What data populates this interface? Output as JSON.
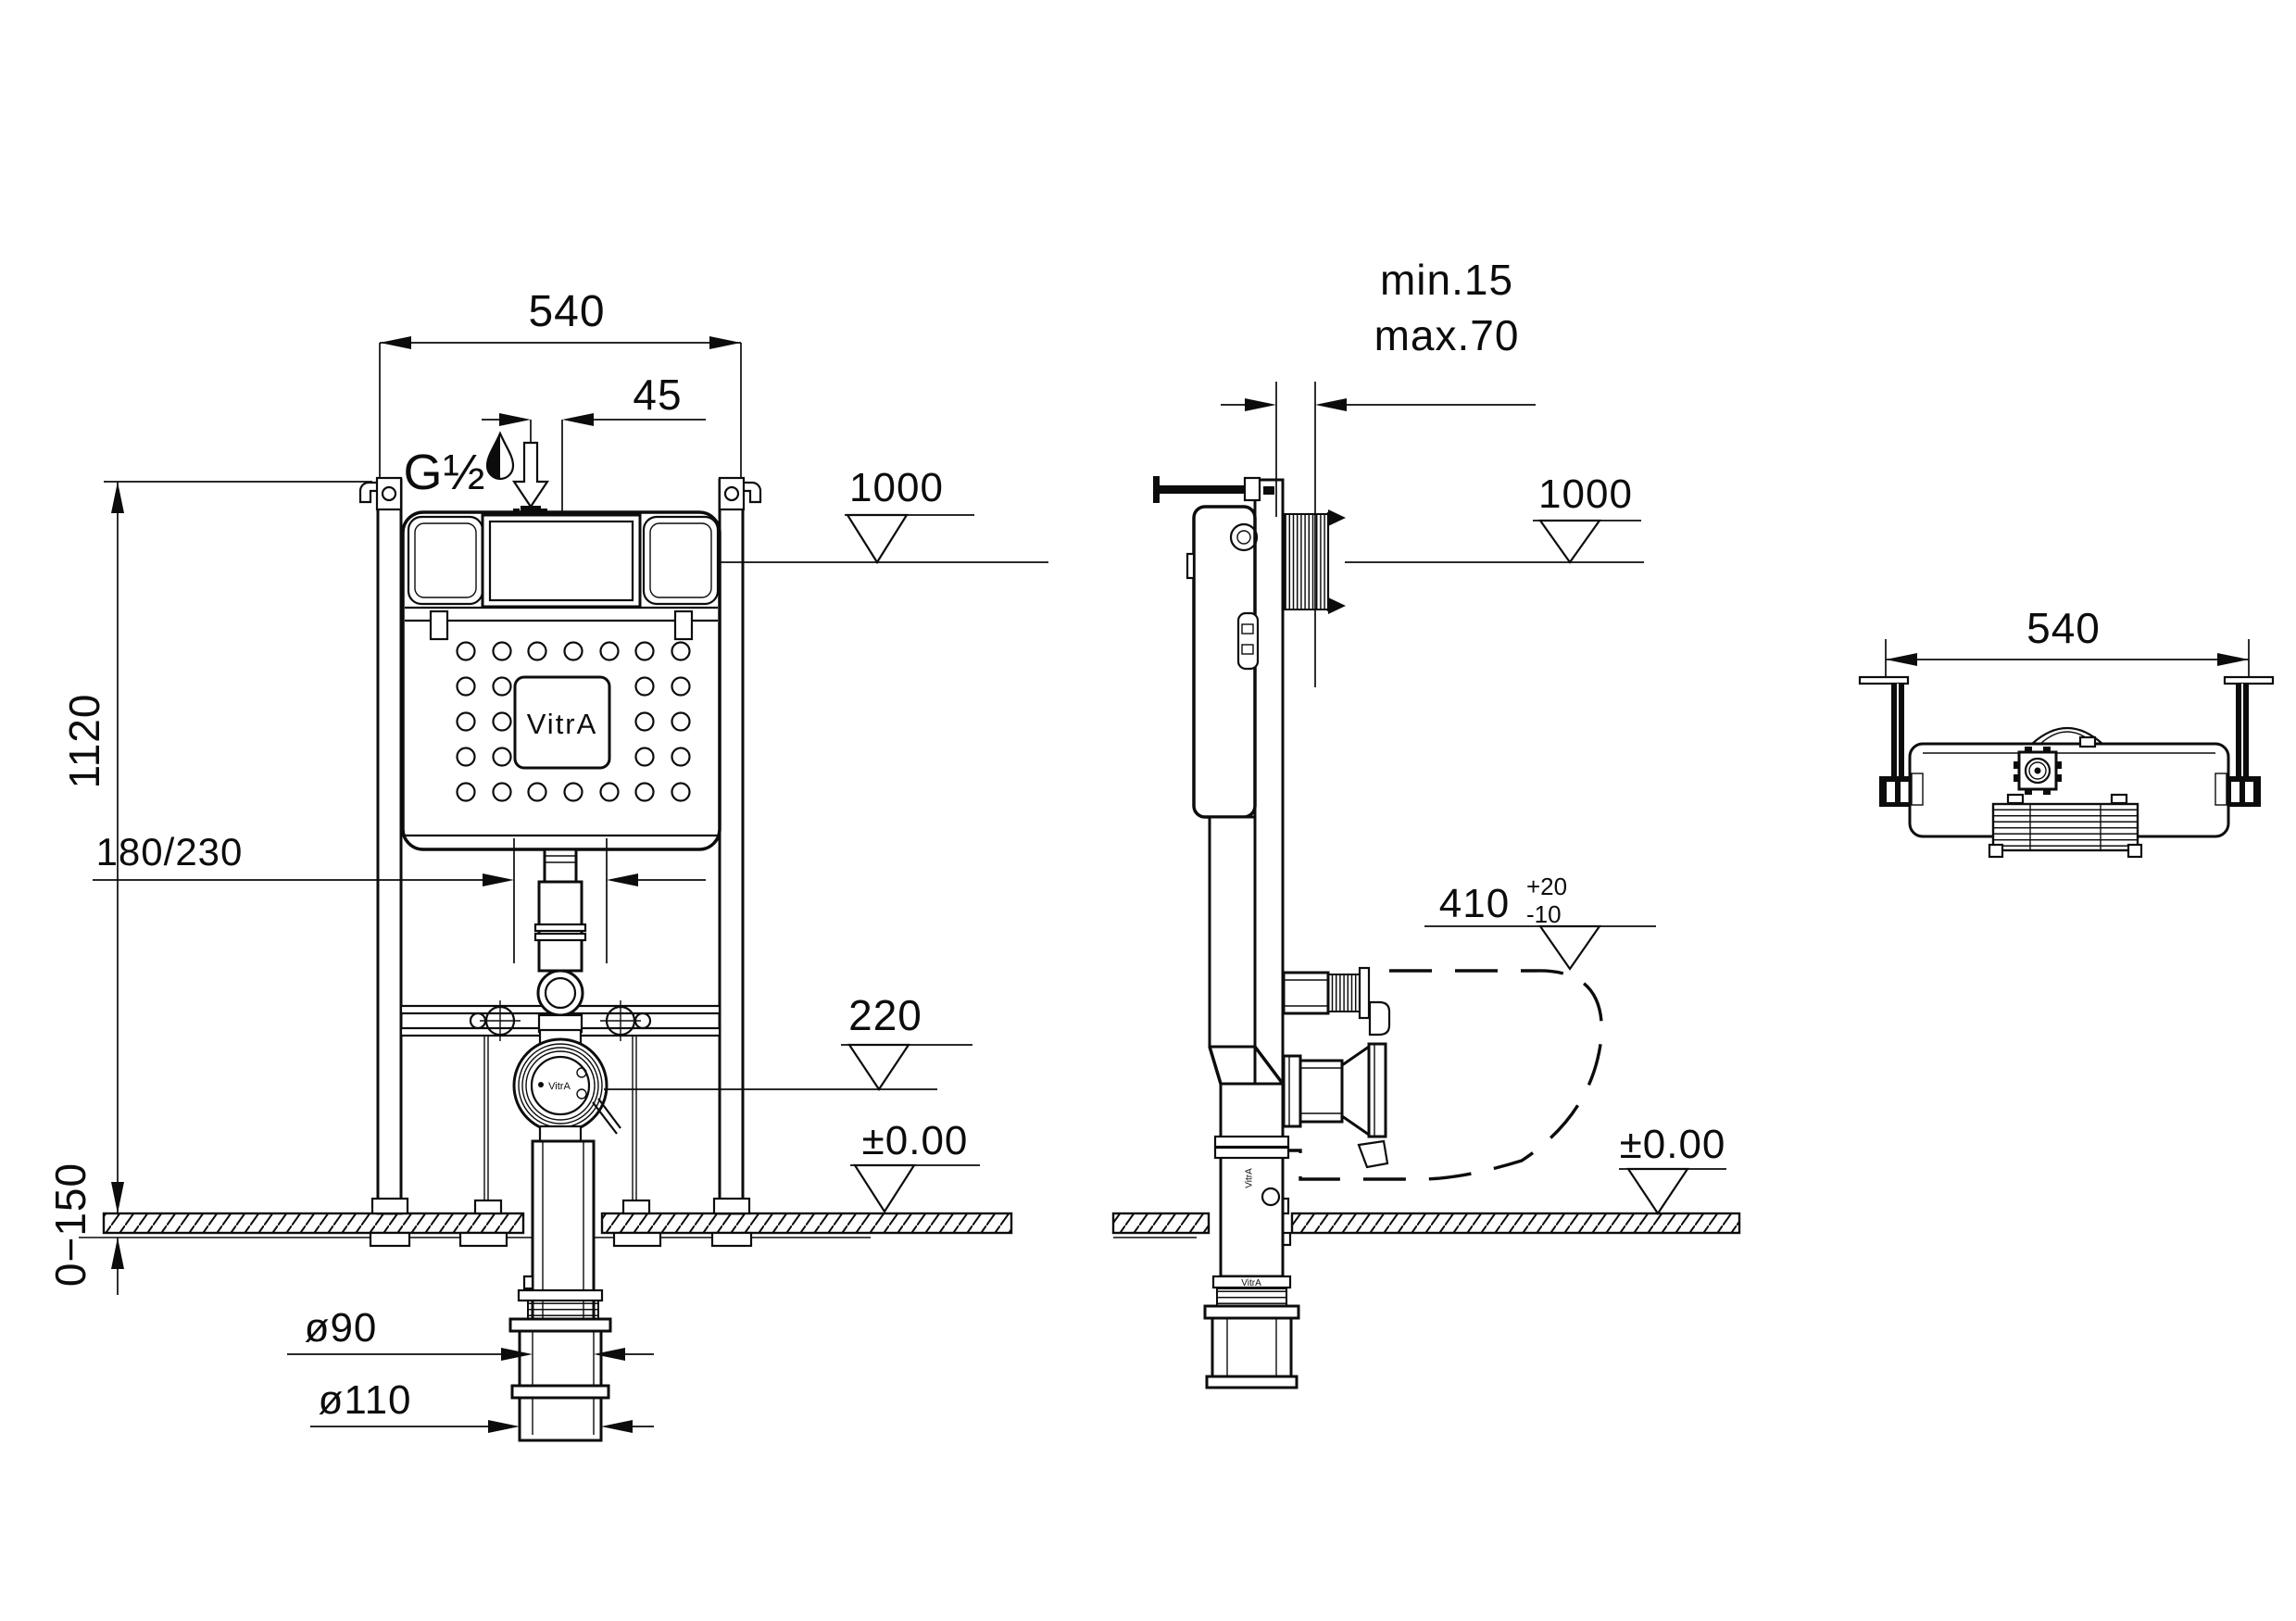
{
  "meta": {
    "brand": "VitrA",
    "drawing_type": "concealed cistern installation drawing",
    "background_color": "#ffffff",
    "line_color": "#0c0c0c"
  },
  "icons": {
    "water_drop": "water-drop",
    "supply_arrow": "hollow-down-arrow",
    "level_marker": "open-triangle-level-symbol",
    "dim_arrow": "filled-dimension-arrowhead"
  },
  "front_view": {
    "dim_width": "540",
    "dim_offset": "45",
    "supply_thread": "G½",
    "dim_height": "1120",
    "dim_drain_offset": "180/230",
    "dim_floor_range": "0−150",
    "dim_drain_inner": "ø90",
    "dim_drain_outer": "ø110",
    "level_top": "1000",
    "level_drain": "220",
    "level_floor": "±0.00",
    "tank_logo": "VitrA",
    "flange_logo": "VitrA"
  },
  "side_view": {
    "dim_wall_min": "min.15",
    "dim_wall_max": "max.70",
    "level_top": "1000",
    "level_pan": "410",
    "level_pan_tol_plus": "+20",
    "level_pan_tol_minus": "-10",
    "level_floor": "±0.00",
    "pipe_logo": "VitrA",
    "pipe_logo_vertical": "VitrA"
  },
  "top_view": {
    "dim_width": "540"
  }
}
